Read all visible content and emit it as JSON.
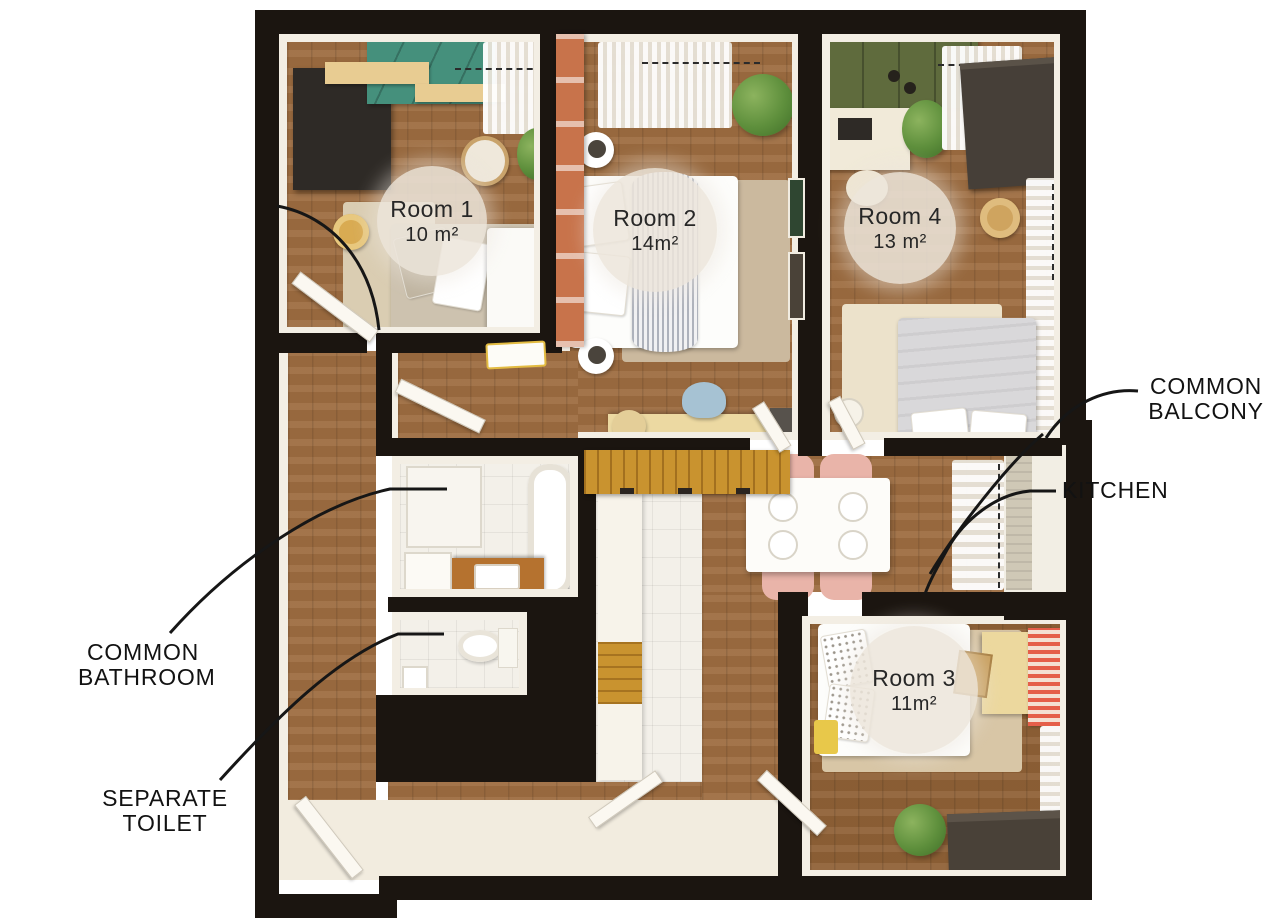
{
  "plan": {
    "title": "Shared apartment floor plan",
    "rooms": [
      {
        "name": "Room 1",
        "area": "10 m²"
      },
      {
        "name": "Room 2",
        "area": "14m²"
      },
      {
        "name": "Room 4",
        "area": "13 m²"
      },
      {
        "name": "Room 3",
        "area": "11m²"
      }
    ],
    "annotations": {
      "balcony": {
        "line1": "COMMON",
        "line2": "BALCONY"
      },
      "kitchen": {
        "line1": "KITCHEN"
      },
      "bathroom": {
        "line1": "COMMON",
        "line2": "BATHROOM"
      },
      "toilet": {
        "line1": "SEPARATE",
        "line2": "TOILET"
      }
    },
    "colors": {
      "wall": "#1b1510",
      "wood_floor": "#9d6c40",
      "tile_floor": "#f3f0e9",
      "entry_floor": "#f2ecdf",
      "accent_terracotta": "#c8734b",
      "wardrobe_teal": "#45907c",
      "wardrobe_olive": "#5f6b3d",
      "furniture_dark": "#2e2a26",
      "chair_blush": "#e9b4a9",
      "chair_blue": "#a6c2d3",
      "rug_red": "#e55f4a",
      "counter_wood": "#c9932f",
      "label_circle_bg": "#ece5db",
      "text": "#121212"
    }
  }
}
